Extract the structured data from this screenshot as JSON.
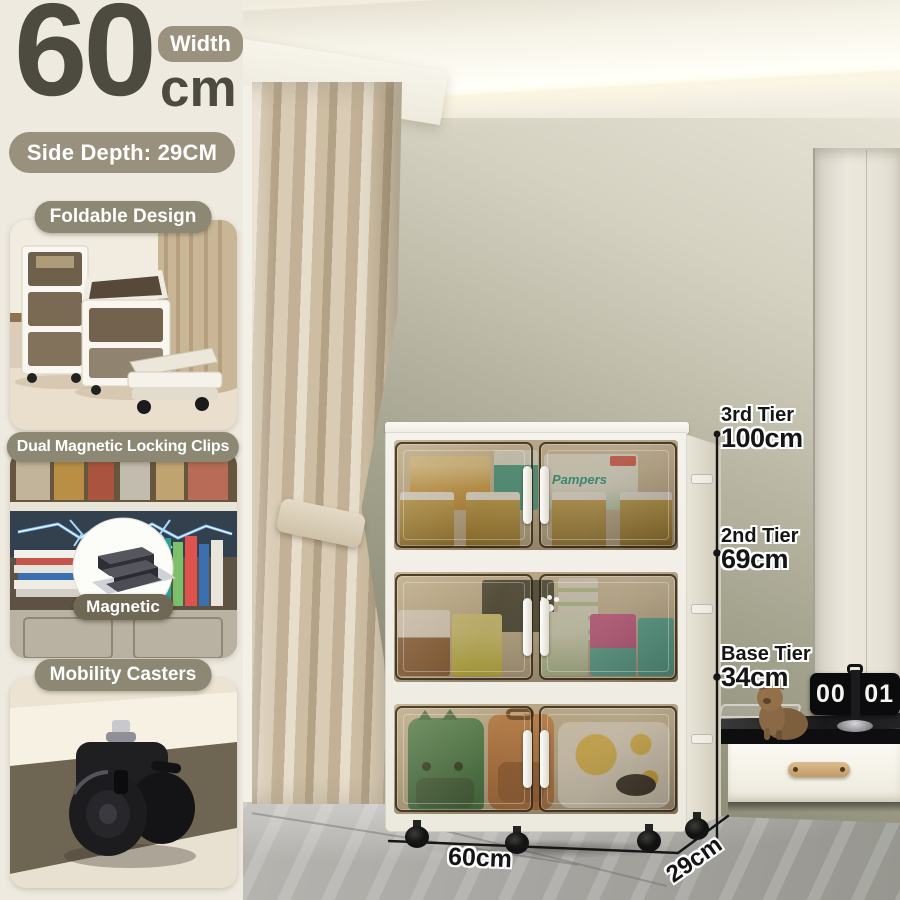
{
  "page": {
    "title": "Foldable Storage Cabinet — Size Guide"
  },
  "size_callout": {
    "width_value": "60",
    "width_unit": "cm",
    "width_badge": "Width",
    "side_depth_label": "Side Depth: 29CM"
  },
  "features": [
    {
      "label": "Foldable Design"
    },
    {
      "label": "Dual Magnetic Locking Clips",
      "badge": "Magnetic"
    },
    {
      "label": "Mobility Casters"
    }
  ],
  "dimensions": {
    "tiers": [
      {
        "name": "3rd Tier",
        "value": "100cm"
      },
      {
        "name": "2nd Tier",
        "value": "69cm"
      },
      {
        "name": "Base Tier",
        "value": "34cm"
      }
    ],
    "width": "60cm",
    "depth": "29cm"
  },
  "scene": {
    "clock_left": "00",
    "clock_right": "01",
    "diaper_brand": "Pampers"
  },
  "colors": {
    "sidebar_bg": "#EFEAE0",
    "accent_taupe": "#99917E",
    "accent_olive": "#8C8874",
    "headline_text": "#4D4A40",
    "wall_olive": "#8F8E79",
    "glass_tint": "rgba(115,90,50,0.42)",
    "dimension_text": "#151515",
    "clock_body": "#0B0B0D"
  }
}
